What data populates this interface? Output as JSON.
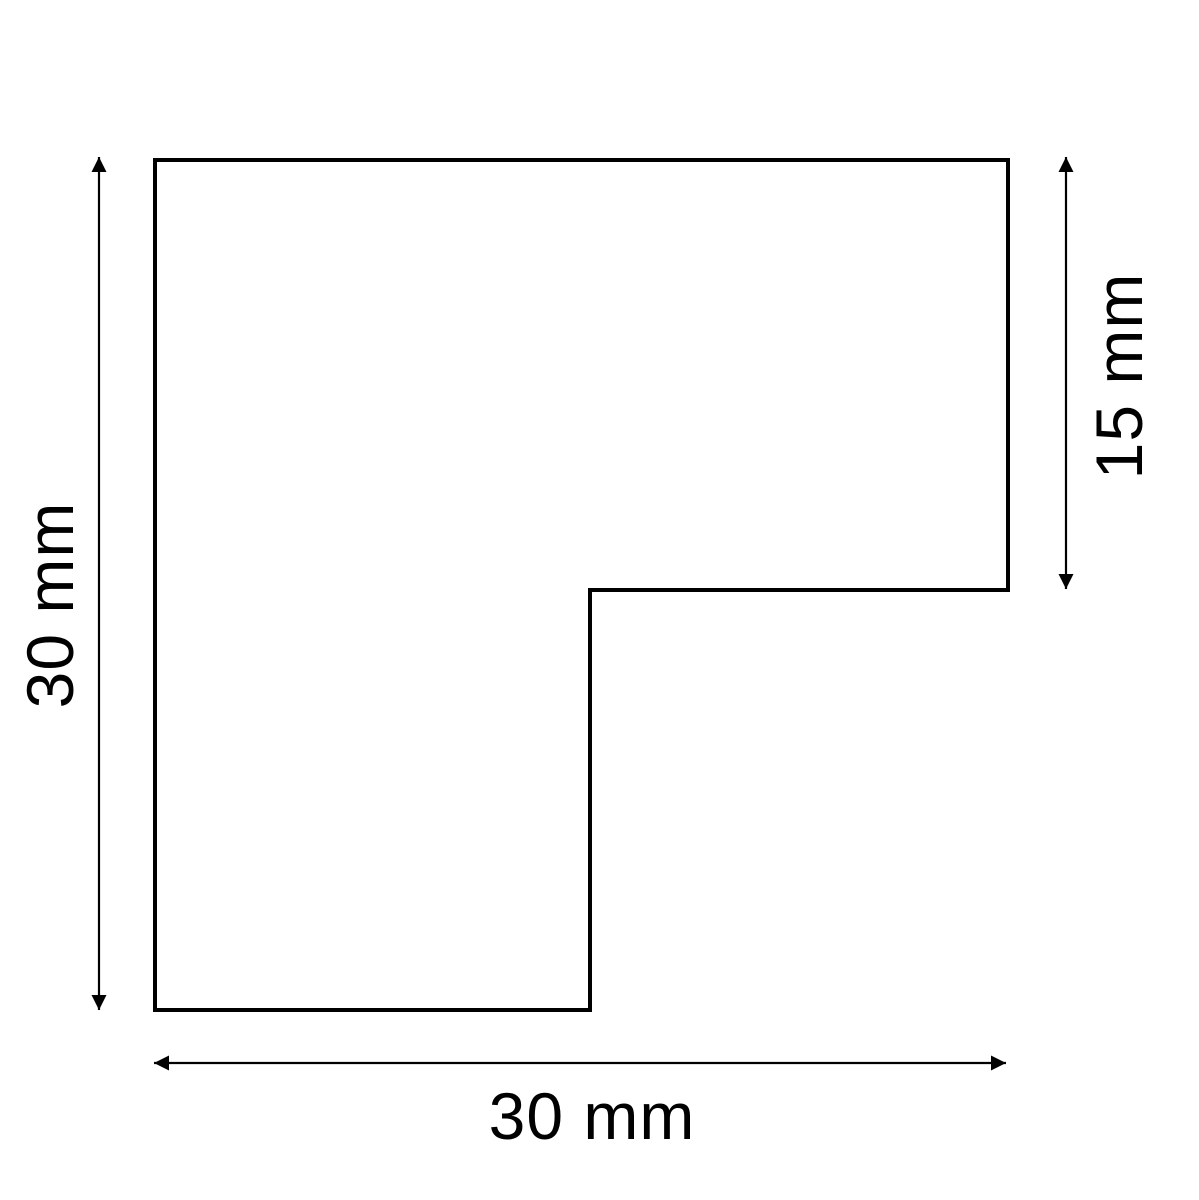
{
  "drawing": {
    "type": "technical-dimension-drawing",
    "unit": "mm",
    "line_color": "#000000",
    "background_color": "#ffffff",
    "shape": {
      "description": "L-shaped profile outline with square notch cut from bottom-right",
      "outline_points": "155,160 1008,160 1008,590 590,590 590,1010 155,1010"
    },
    "dimensions": {
      "left": {
        "label": "30 mm",
        "value": 30
      },
      "right": {
        "label": "15 mm",
        "value": 15
      },
      "bottom": {
        "label": "30 mm",
        "value": 30
      }
    }
  }
}
